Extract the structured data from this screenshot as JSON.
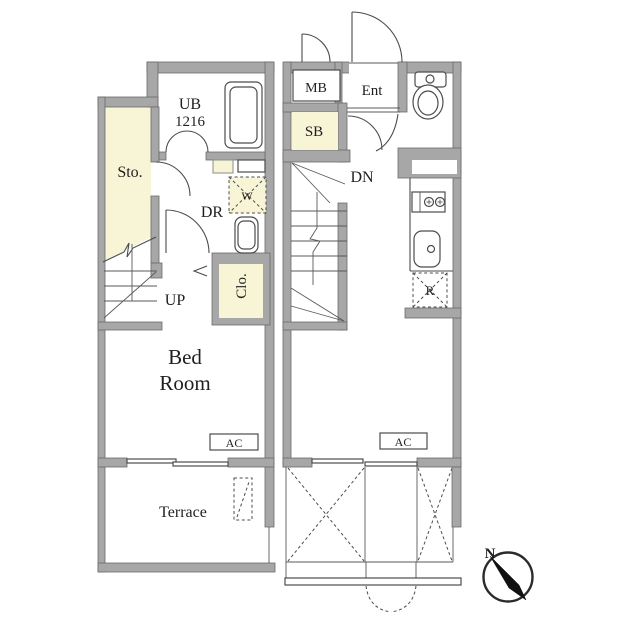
{
  "colors": {
    "wall": "#a7a7a7",
    "wall_outline": "#6b6b6b",
    "accent_room_fill": "#f8f4d6",
    "drawing_line": "#4c4c4c",
    "text": "#1f1f1f",
    "background": "#ffffff"
  },
  "lower_floor": {
    "storage_label": "Sto.",
    "unit_bath_label": "UB",
    "unit_bath_size": "1216",
    "dressing_room_label": "DR",
    "washer_label": "W",
    "stairs_label": "UP",
    "closet_label": "Clo.",
    "bedroom_label_line1": "Bed",
    "bedroom_label_line2": "Room",
    "ac_label": "AC",
    "terrace_label": "Terrace"
  },
  "upper_floor": {
    "meter_box_label": "MB",
    "entrance_label": "Ent",
    "shoe_box_label": "SB",
    "stairs_label": "DN",
    "refrigerator_label": "R",
    "ac_label": "AC"
  },
  "compass": {
    "north_label": "N"
  }
}
